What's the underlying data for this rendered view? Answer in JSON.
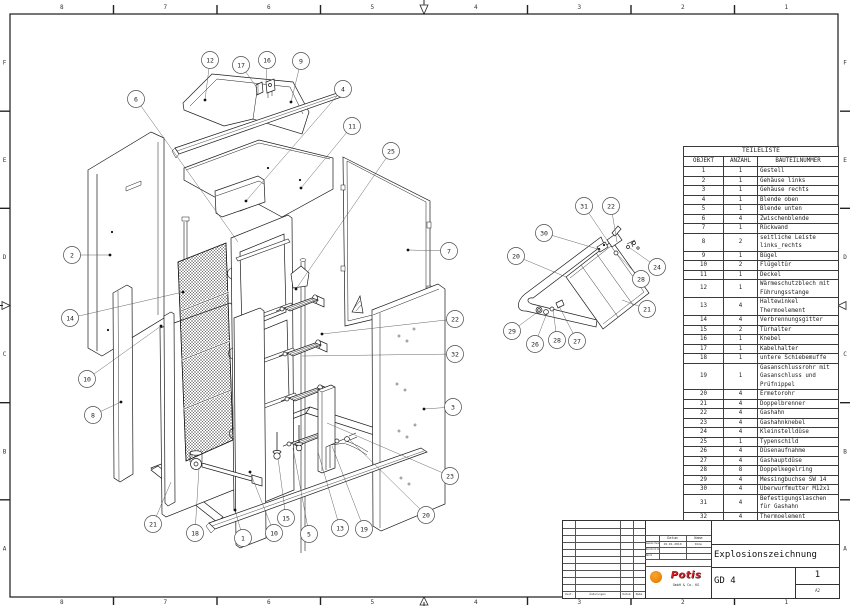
{
  "border": {
    "columns": [
      "8",
      "7",
      "6",
      "5",
      "4",
      "3",
      "2",
      "1"
    ],
    "rows": [
      "F",
      "E",
      "D",
      "C",
      "B",
      "A"
    ]
  },
  "parts_list": {
    "title": "TEILELISTE",
    "columns": [
      "OBJEKT",
      "ANZAHL",
      "BAUTEILNUMMER"
    ],
    "rows": [
      {
        "objekt": "1",
        "anzahl": "1",
        "name": "Gestell"
      },
      {
        "objekt": "2",
        "anzahl": "1",
        "name": "Gehäuse links"
      },
      {
        "objekt": "3",
        "anzahl": "1",
        "name": "Gehäuse rechts"
      },
      {
        "objekt": "4",
        "anzahl": "1",
        "name": "Blende oben"
      },
      {
        "objekt": "5",
        "anzahl": "1",
        "name": "Blende unten"
      },
      {
        "objekt": "6",
        "anzahl": "4",
        "name": "Zwischenblende"
      },
      {
        "objekt": "7",
        "anzahl": "1",
        "name": "Rückwand"
      },
      {
        "objekt": "8",
        "anzahl": "2",
        "name": "seitliche Leiste\nlinks_rechts"
      },
      {
        "objekt": "9",
        "anzahl": "1",
        "name": "Bügel"
      },
      {
        "objekt": "10",
        "anzahl": "2",
        "name": "Flügeltür"
      },
      {
        "objekt": "11",
        "anzahl": "1",
        "name": "Deckel"
      },
      {
        "objekt": "12",
        "anzahl": "1",
        "name": "Wärmeschutzblech mit\nFührungsstange"
      },
      {
        "objekt": "13",
        "anzahl": "4",
        "name": "Haltewinkel\nThermoelement"
      },
      {
        "objekt": "14",
        "anzahl": "4",
        "name": "Verbrennungsgitter"
      },
      {
        "objekt": "15",
        "anzahl": "2",
        "name": "Türhalter"
      },
      {
        "objekt": "16",
        "anzahl": "1",
        "name": "Knebel"
      },
      {
        "objekt": "17",
        "anzahl": "1",
        "name": "Kabelhalter"
      },
      {
        "objekt": "18",
        "anzahl": "1",
        "name": "untere Schiebemuffe"
      },
      {
        "objekt": "19",
        "anzahl": "1",
        "name": "Gasanschlussrohr mit\nGasanschluss und\nPrüfnippel"
      },
      {
        "objekt": "20",
        "anzahl": "4",
        "name": "Ermetorohr"
      },
      {
        "objekt": "21",
        "anzahl": "4",
        "name": "Doppelbrenner"
      },
      {
        "objekt": "22",
        "anzahl": "4",
        "name": "Gashahn"
      },
      {
        "objekt": "23",
        "anzahl": "4",
        "name": "Gashahnknebel"
      },
      {
        "objekt": "24",
        "anzahl": "4",
        "name": "Kleinstelldüse"
      },
      {
        "objekt": "25",
        "anzahl": "1",
        "name": "Typenschild"
      },
      {
        "objekt": "26",
        "anzahl": "4",
        "name": "Düsenaufnahme"
      },
      {
        "objekt": "27",
        "anzahl": "4",
        "name": "Gashauptdüse"
      },
      {
        "objekt": "28",
        "anzahl": "8",
        "name": "Doppelkegelring"
      },
      {
        "objekt": "29",
        "anzahl": "4",
        "name": "Messingbuchse SW 14"
      },
      {
        "objekt": "30",
        "anzahl": "4",
        "name": "Überwurfmutter M12x1"
      },
      {
        "objekt": "31",
        "anzahl": "4",
        "name": "Befestigungslaschen\nfür Gashahn"
      },
      {
        "objekt": "32",
        "anzahl": "4",
        "name": "Thermoelement"
      }
    ]
  },
  "title_block": {
    "title": "Explosionszeichnung",
    "drawing_number": "GD 4",
    "sheet": "1",
    "format": "A2",
    "brand": "Potis",
    "company_suffix": "GmbH & Co. KG",
    "approval": {
      "date_header": "Datum",
      "name_header": "Name",
      "rows": [
        {
          "label": "Gezeichnet",
          "date": "19.01.2010",
          "name": "Dimu"
        },
        {
          "label": "Kontrolliert",
          "date": "",
          "name": ""
        },
        {
          "label": "Norm",
          "date": "",
          "name": ""
        }
      ]
    },
    "revision_labels": [
      "Zust.",
      "Änderungen",
      "Datum",
      "Name"
    ]
  },
  "balloons": [
    {
      "n": "12",
      "x": 210,
      "y": 60,
      "tx": 205,
      "ty": 100,
      "dot": true
    },
    {
      "n": "17",
      "x": 241,
      "y": 65,
      "tx": 257,
      "ty": 88,
      "dot": false
    },
    {
      "n": "16",
      "x": 267,
      "y": 60,
      "tx": 266,
      "ty": 84,
      "dot": false
    },
    {
      "n": "9",
      "x": 301,
      "y": 61,
      "tx": 291,
      "ty": 102,
      "dot": true
    },
    {
      "n": "4",
      "x": 343,
      "y": 89,
      "tx": 246,
      "ty": 201,
      "dot": true
    },
    {
      "n": "6",
      "x": 136,
      "y": 99,
      "tx": 238,
      "ty": 242,
      "dot": false
    },
    {
      "n": "11",
      "x": 352,
      "y": 126,
      "tx": 301,
      "ty": 188,
      "dot": true
    },
    {
      "n": "25",
      "x": 391,
      "y": 151,
      "tx": 296,
      "ty": 289,
      "dot": true
    },
    {
      "n": "2",
      "x": 72,
      "y": 255,
      "tx": 110,
      "ty": 255,
      "dot": true
    },
    {
      "n": "14",
      "x": 70,
      "y": 318,
      "tx": 183,
      "ty": 292,
      "dot": true
    },
    {
      "n": "10",
      "x": 87,
      "y": 379,
      "tx": 161,
      "ty": 326,
      "dot": true
    },
    {
      "n": "8",
      "x": 93,
      "y": 415,
      "tx": 121,
      "ty": 402,
      "dot": true
    },
    {
      "n": "21",
      "x": 153,
      "y": 524,
      "tx": 171,
      "ty": 482,
      "dot": false
    },
    {
      "n": "18",
      "x": 195,
      "y": 533,
      "tx": 199,
      "ty": 468,
      "dot": false
    },
    {
      "n": "1",
      "x": 243,
      "y": 538,
      "tx": 235,
      "ty": 510,
      "dot": true
    },
    {
      "n": "10",
      "x": 274,
      "y": 533,
      "tx": 250,
      "ty": 472,
      "dot": true
    },
    {
      "n": "15",
      "x": 286,
      "y": 518,
      "tx": 278,
      "ty": 458,
      "dot": false
    },
    {
      "n": "5",
      "x": 309,
      "y": 534,
      "tx": 293,
      "ty": 448,
      "dot": false
    },
    {
      "n": "13",
      "x": 340,
      "y": 528,
      "tx": 318,
      "ty": 452,
      "dot": false
    },
    {
      "n": "19",
      "x": 364,
      "y": 529,
      "tx": 332,
      "ty": 446,
      "dot": false
    },
    {
      "n": "20",
      "x": 426,
      "y": 515,
      "tx": 350,
      "ty": 440,
      "dot": false
    },
    {
      "n": "7",
      "x": 449,
      "y": 251,
      "tx": 408,
      "ty": 250,
      "dot": true
    },
    {
      "n": "22",
      "x": 455,
      "y": 319,
      "tx": 322,
      "ty": 334,
      "dot": true
    },
    {
      "n": "32",
      "x": 455,
      "y": 354,
      "tx": 302,
      "ty": 356,
      "dot": false
    },
    {
      "n": "3",
      "x": 453,
      "y": 407,
      "tx": 424,
      "ty": 409,
      "dot": true
    },
    {
      "n": "23",
      "x": 450,
      "y": 476,
      "tx": 327,
      "ty": 423,
      "dot": false
    },
    {
      "n": "31",
      "x": 584,
      "y": 206,
      "tx": 607,
      "ty": 240,
      "dot": false
    },
    {
      "n": "22",
      "x": 611,
      "y": 206,
      "tx": 617,
      "ty": 242,
      "dot": false
    },
    {
      "n": "30",
      "x": 544,
      "y": 233,
      "tx": 601,
      "ty": 250,
      "dot": false
    },
    {
      "n": "20",
      "x": 516,
      "y": 256,
      "tx": 566,
      "ty": 277,
      "dot": false
    },
    {
      "n": "24",
      "x": 657,
      "y": 267,
      "tx": 630,
      "ty": 248,
      "dot": false
    },
    {
      "n": "28",
      "x": 641,
      "y": 279,
      "tx": 617,
      "ty": 254,
      "dot": false
    },
    {
      "n": "21",
      "x": 647,
      "y": 309,
      "tx": 622,
      "ty": 300,
      "dot": false
    },
    {
      "n": "29",
      "x": 512,
      "y": 331,
      "tx": 539,
      "ty": 311,
      "dot": false
    },
    {
      "n": "26",
      "x": 535,
      "y": 344,
      "tx": 547,
      "ty": 313,
      "dot": false
    },
    {
      "n": "28",
      "x": 557,
      "y": 340,
      "tx": 553,
      "ty": 309,
      "dot": false
    },
    {
      "n": "27",
      "x": 577,
      "y": 341,
      "tx": 559,
      "ty": 306,
      "dot": false
    }
  ]
}
